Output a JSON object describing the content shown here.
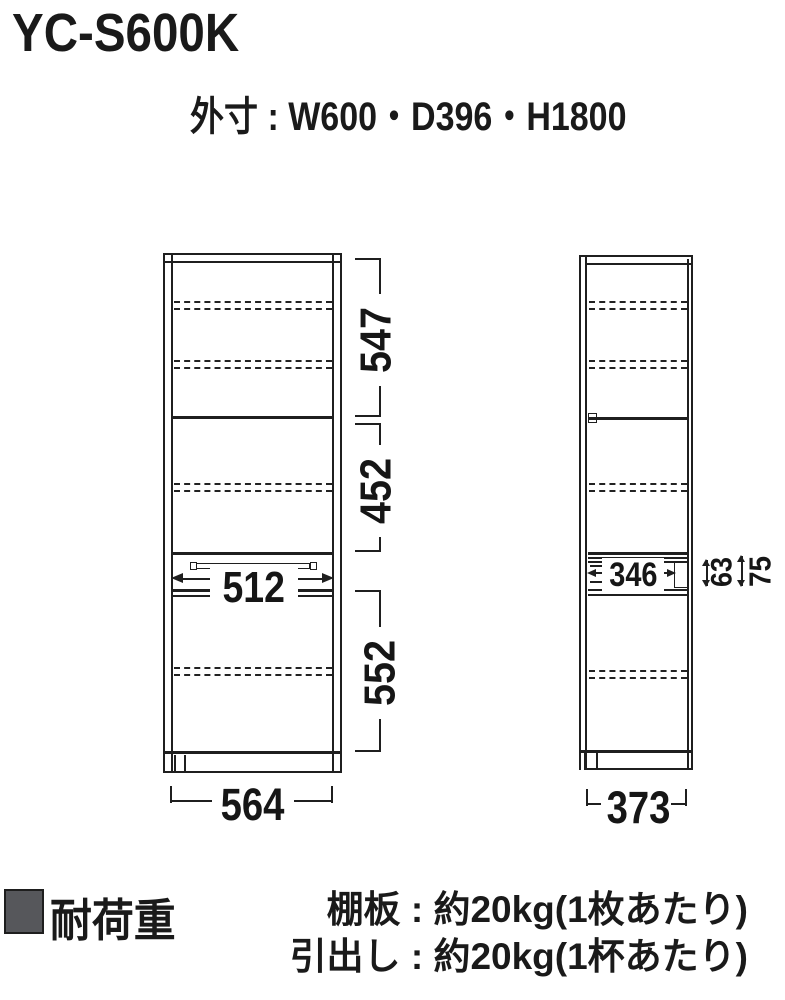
{
  "header": {
    "model": "YC-S600K",
    "outer_size": "外寸 : W600・D396・H1800"
  },
  "front_view": {
    "section_top": "547",
    "section_middle": "452",
    "section_bottom": "552",
    "drawer_width": "512",
    "overall_width": "564"
  },
  "side_view": {
    "drawer_depth": "346",
    "drawer_front_height": "63",
    "drawer_section_height": "75",
    "overall_depth": "373"
  },
  "footer": {
    "heading": "耐荷重",
    "shelf_note": "棚板 : 約20kg(1枚あたり)",
    "drawer_note": "引出し : 約20kg(1杯あたり)"
  },
  "colors": {
    "line": "#1f1f1f",
    "legend_square": "#56575b"
  }
}
